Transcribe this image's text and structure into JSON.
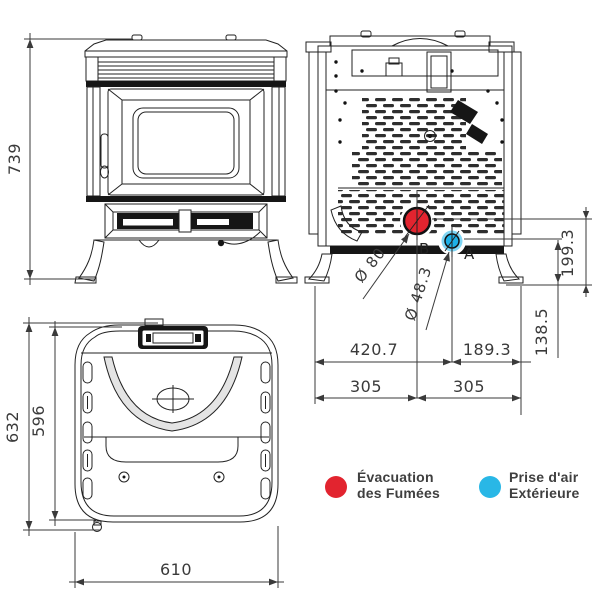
{
  "dimensions": {
    "front": {
      "height": "739"
    },
    "rear": {
      "smoke_outlet_height": "199.3",
      "air_inlet_height": "138.5",
      "smoke_outlet_diameter": "Ø 80",
      "air_inlet_diameter": "Ø 48.3",
      "smoke_outlet_label": "B",
      "air_inlet_label": "A",
      "air_inlet_from_left": "420.7",
      "air_inlet_from_right": "189.3",
      "smoke_outlet_from_left": "305",
      "smoke_outlet_from_right": "305"
    },
    "top": {
      "depth_total": "632",
      "depth_body": "596",
      "width": "610"
    }
  },
  "legend": {
    "smoke": {
      "line1": "Évacuation",
      "line2": "des Fumées",
      "color": "#e2242f"
    },
    "air": {
      "line1": "Prise d'air",
      "line2": "Extérieure",
      "color": "#29b7e6"
    }
  },
  "colors": {
    "smoke_marker": "#e2242f",
    "air_marker": "#1db1e8",
    "air_marker_halo": "#7fd6f5"
  }
}
